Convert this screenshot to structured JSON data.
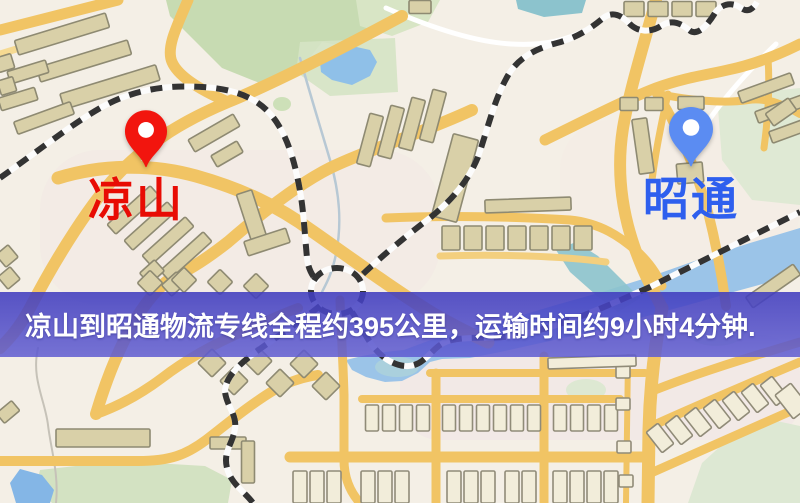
{
  "page": {
    "width": 800,
    "height": 503,
    "kind": "logistics-route-map-image"
  },
  "map": {
    "type": "stylized-city-street-map",
    "markers": [
      {
        "id": "origin",
        "label": "凉山",
        "pin_color": "#f2150e",
        "label_color": "#e80c04",
        "pin_tip_x": 146,
        "pin_tip_y": 172
      },
      {
        "id": "destination",
        "label": "昭通",
        "pin_color": "#5b8cf2",
        "label_color": "#2e5fee",
        "pin_tip_x": 691,
        "pin_tip_y": 170
      }
    ],
    "colors": {
      "background": "#f4efe6",
      "road_yellow": "#f1c464",
      "building_tan": "#d9d0a8",
      "building_outline": "#8e8a72",
      "park_green": "#c7dbb2",
      "water_blue": "#9bc4e8",
      "water_teal": "#8cc3cd",
      "railway_dark": "#333333"
    }
  },
  "banner": {
    "text": "凉山到昭通物流专线全程约395公里，运输时间约9小时4分钟.",
    "background": "rgba(74,70,202,0.84)",
    "text_color": "#ffffff"
  },
  "route_info": {
    "origin": "凉山",
    "destination": "昭通",
    "distance_text": "约395公里",
    "duration_text": "约9小时4分钟"
  }
}
